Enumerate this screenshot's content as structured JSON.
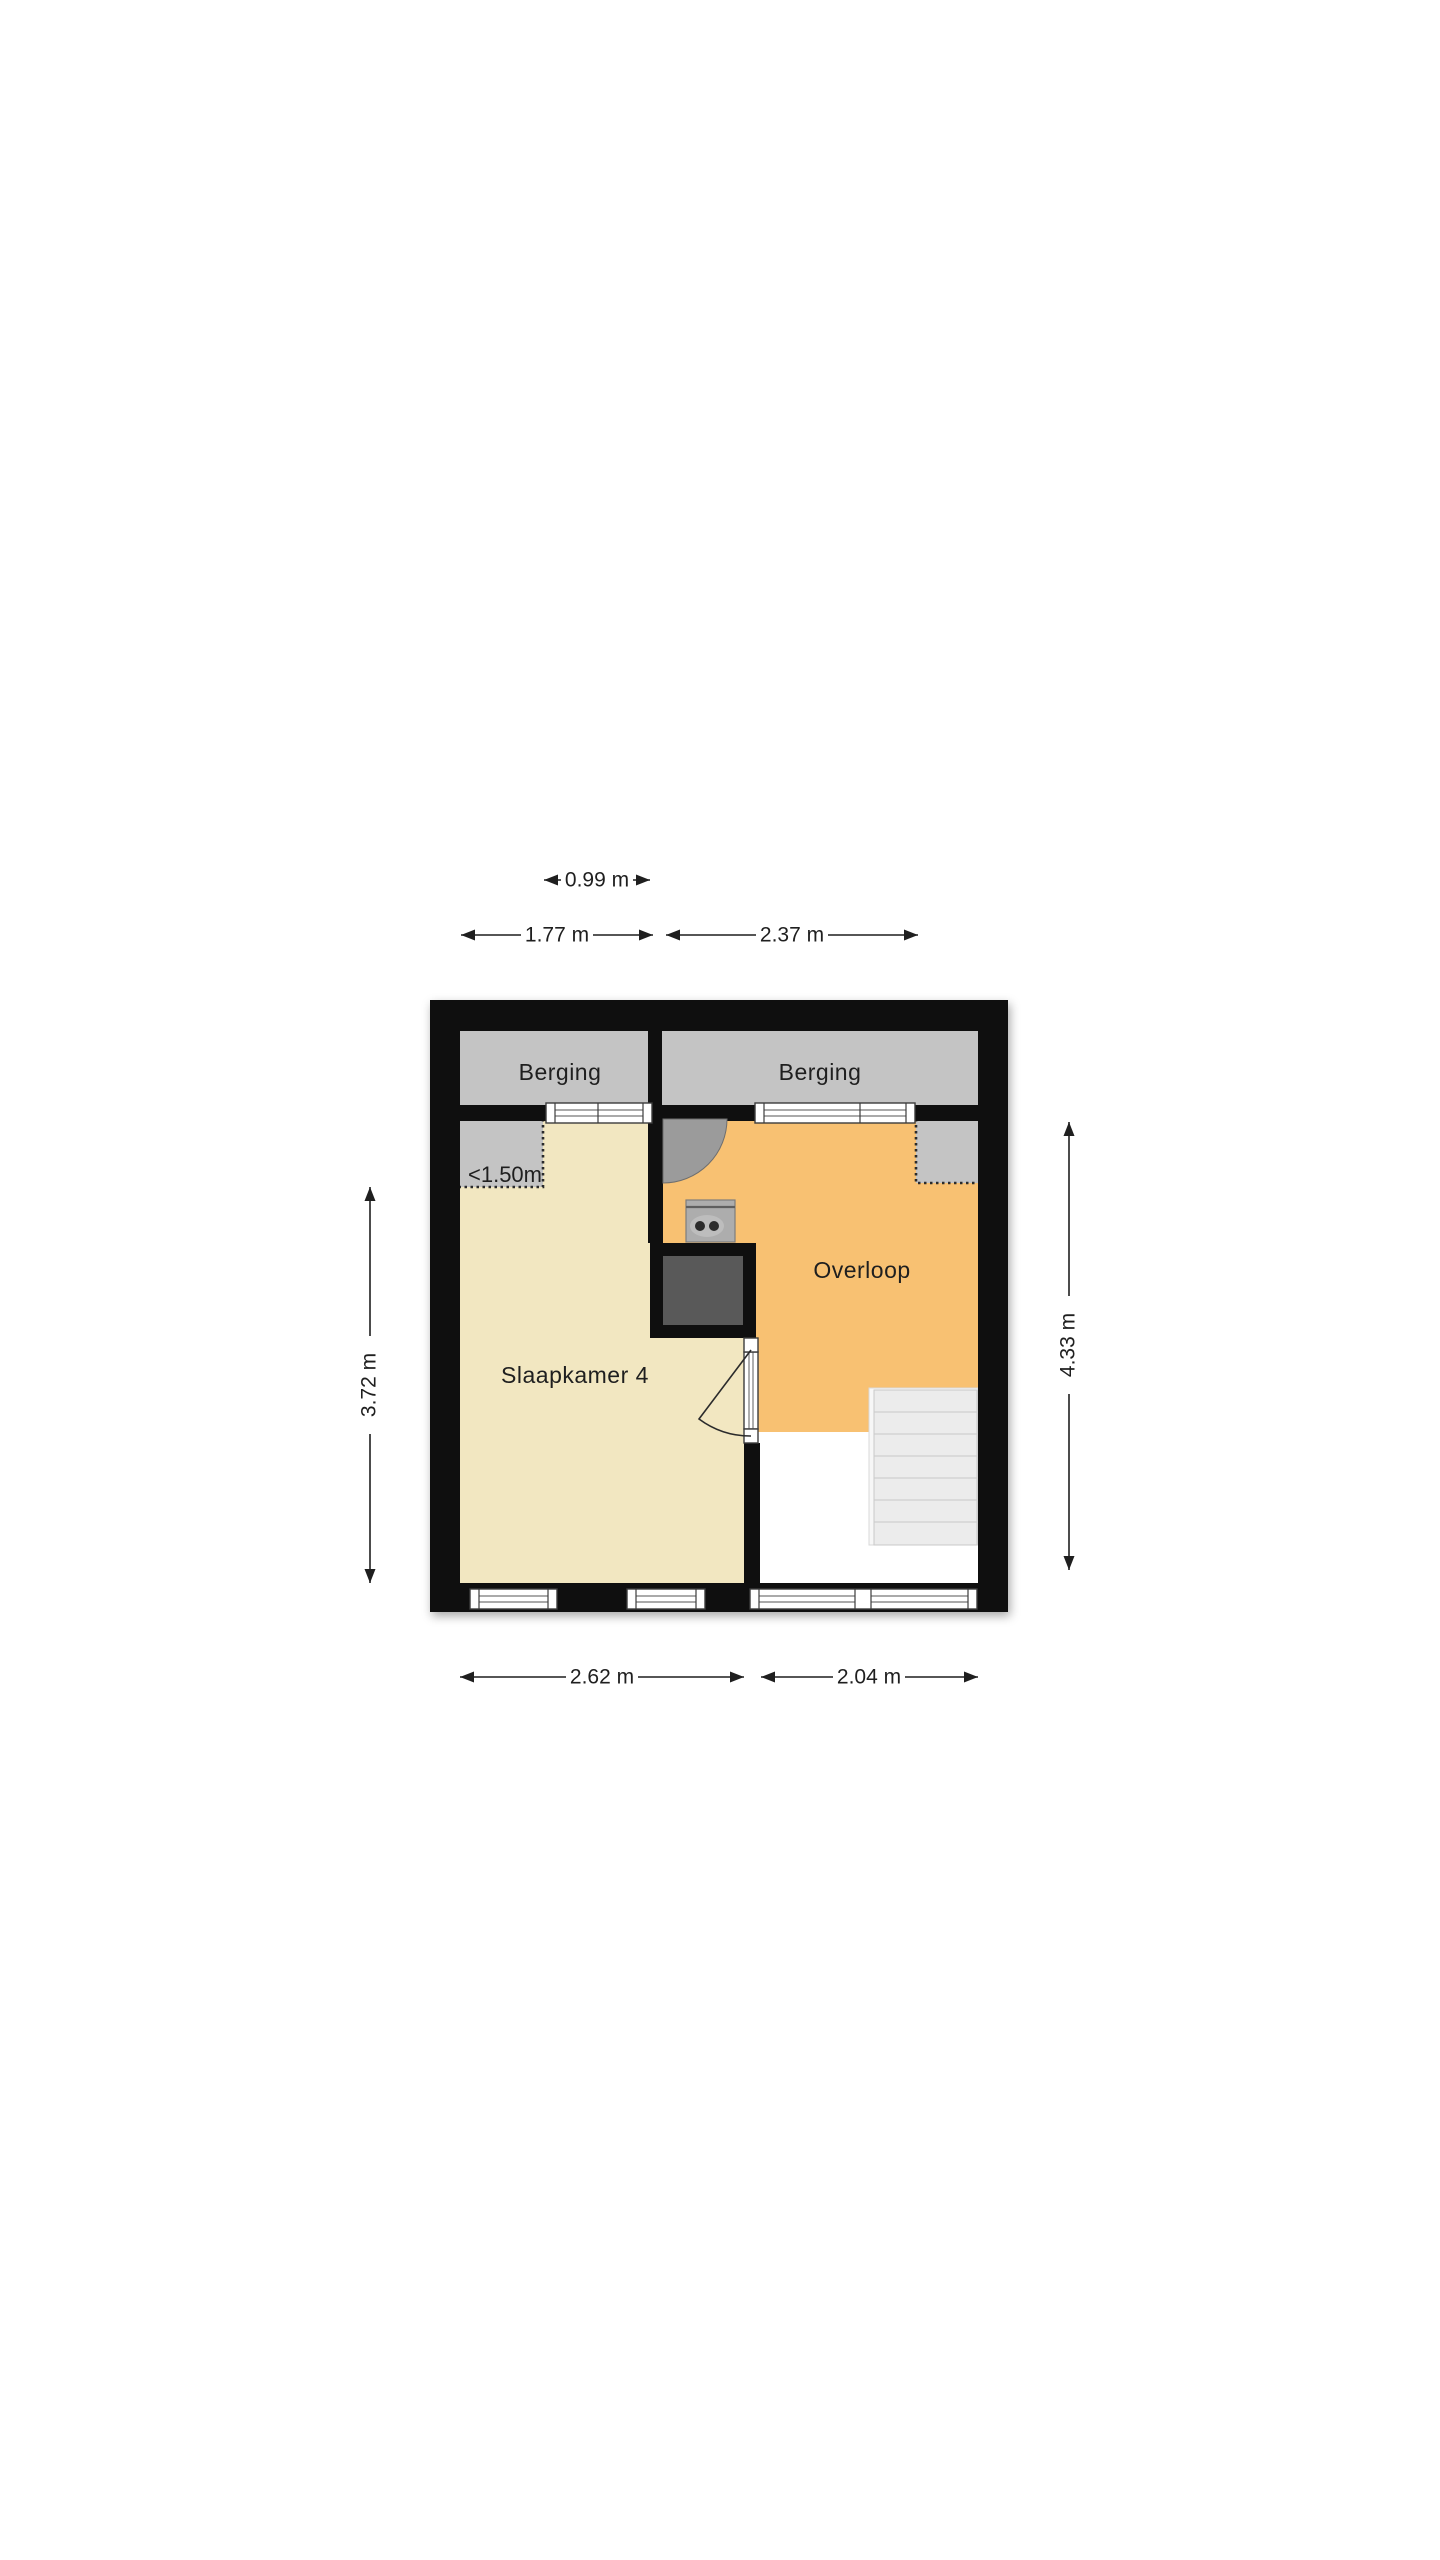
{
  "floorplan": {
    "rooms": [
      {
        "id": "berging-left",
        "label": "Berging"
      },
      {
        "id": "berging-right",
        "label": "Berging"
      },
      {
        "id": "overloop",
        "label": "Overloop"
      },
      {
        "id": "slaapkamer-4",
        "label": "Slaapkamer 4"
      }
    ],
    "annotations": {
      "low_ceiling": "<1.50m"
    },
    "dimensions": {
      "top_inner": "0.99 m",
      "top_left": "1.77 m",
      "top_right": "2.37 m",
      "bottom_left": "2.62 m",
      "bottom_right": "2.04 m",
      "side_left": "3.72 m",
      "side_right": "4.33 m"
    },
    "colors": {
      "wall": "#0f0f0f",
      "floor_bedroom": "#f2e7c1",
      "floor_hall": "#f8c172",
      "storage_gray": "#c4c4c4",
      "closet_dark": "#595959",
      "stair_tread": "#ececec",
      "background": "#ffffff"
    }
  }
}
